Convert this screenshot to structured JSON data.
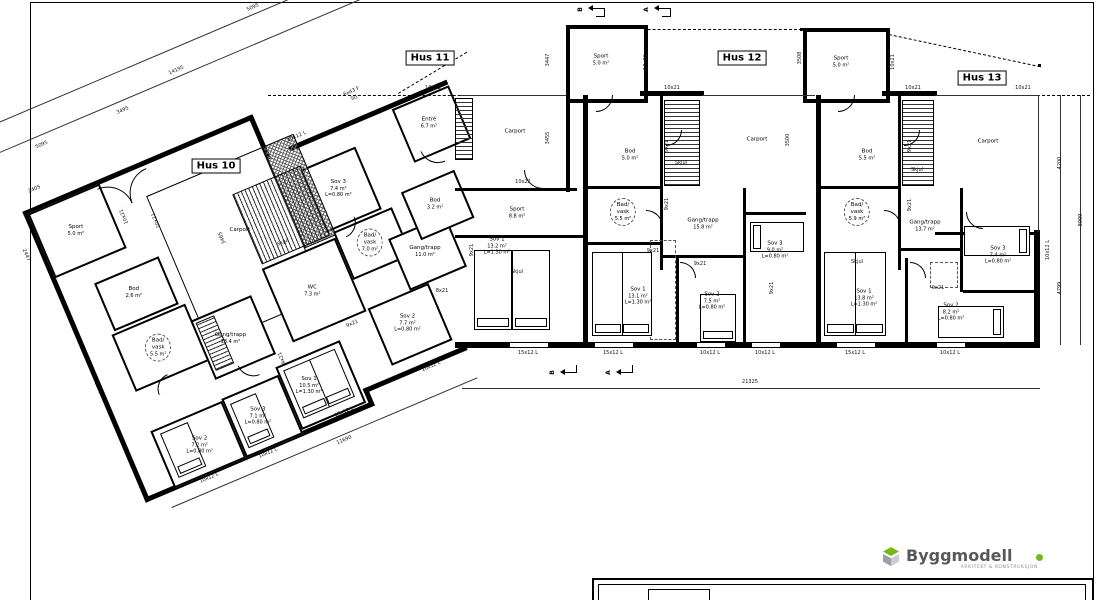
{
  "houses": {
    "h10": "Hus 10",
    "h11": "Hus 11",
    "h12": "Hus 12",
    "h13": "Hus 13"
  },
  "rooms": {
    "h10_sport": {
      "n": "Sport",
      "a": "5.0 m²"
    },
    "h10_carport": {
      "n": "Carport"
    },
    "h10_bod": {
      "n": "Bod",
      "a": "2.6 m²"
    },
    "h10_bad": {
      "n": "Bad/",
      "n2": "vask",
      "a": "5.5 m²"
    },
    "h10_gang": {
      "n": "Gang/trapp",
      "a": "13.4 m²"
    },
    "h10_wc": {
      "n": "WC",
      "a": "7.3 m²"
    },
    "h10_sov2": {
      "n": "Sov 2",
      "a": "7.2 m²",
      "l": "L=0.80 m²"
    },
    "h10_sov3": {
      "n": "Sov 3",
      "a": "7.1 m²",
      "l": "L=0.80 m²"
    },
    "h10_sov1": {
      "n": "Sov 1",
      "a": "10.5 m²",
      "l": "L=1.30 m²"
    },
    "h11_entre": {
      "n": "Entré",
      "a": "6.7 m²"
    },
    "h11_sov3": {
      "n": "Sov 3",
      "a": "7.4 m²",
      "l": "L=0.80 m²"
    },
    "h11_bad": {
      "n": "Bad/",
      "n2": "vask",
      "a": "7.0 m²"
    },
    "h11_gang": {
      "n": "Gang/trapp",
      "a": "11.0 m²"
    },
    "h11_sov2": {
      "n": "Sov 2",
      "a": "7.7 m²",
      "l": "L=0.80 m²"
    },
    "h11_bod": {
      "n": "Bod",
      "a": "3.2 m²"
    },
    "h11_carport": {
      "n": "Carport"
    },
    "h11_sport": {
      "n": "Sport",
      "a": "8.8 m²"
    },
    "h11_sov1": {
      "n": "Sov 1",
      "a": "13.2 m²",
      "l": "L=1.30 m²"
    },
    "shed1": {
      "n": "Sport",
      "a": "5.0 m²"
    },
    "shed2": {
      "n": "Sport",
      "a": "5.0 m²"
    },
    "h12_bod": {
      "n": "Bod",
      "a": "5.0 m²"
    },
    "h12_bad": {
      "n": "Bad/",
      "n2": "vask",
      "a": "5.5 m²"
    },
    "h12_gang": {
      "n": "Gang/trapp",
      "a": "15.8 m²"
    },
    "h12_carport": {
      "n": "Carport"
    },
    "h12_sov3": {
      "n": "Sov 3",
      "a": "9.0 m²",
      "l": "L=0.80 m²"
    },
    "h12_sov1": {
      "n": "Sov 1",
      "a": "13.1 m²",
      "l": "L=1.30 m²"
    },
    "h12_sov2": {
      "n": "Sov 2",
      "a": "7.5 m²",
      "l": "L=0.80 m²"
    },
    "h13_bod": {
      "n": "Bod",
      "a": "5.5 m²"
    },
    "h13_bad": {
      "n": "Bad/",
      "n2": "vask",
      "a": "5.9 m²"
    },
    "h13_gang": {
      "n": "Gang/trapp",
      "a": "13.7 m²"
    },
    "h13_carport": {
      "n": "Carport"
    },
    "h13_sov3": {
      "n": "Sov 3",
      "a": "7.4 m²",
      "l": "L=0.80 m²"
    },
    "h13_sov1": {
      "n": "Sov 1",
      "a": "13.8 m²",
      "l": "L=1.30 m²"
    },
    "h13_sov2": {
      "n": "Sov 2",
      "a": "8.2 m²",
      "l": "L=0.80 m²"
    }
  },
  "codes": {
    "d10x21": "10x21",
    "d9x21": "9x21",
    "d8x21": "8x21",
    "w15": "15x12 L",
    "w10": "10x12 L",
    "skjul": "Skjul",
    "sg1": "6x43 F",
    "sg2": "SG"
  },
  "dims": {
    "d5095": "5095",
    "d14195": "14195",
    "d3495": "3495",
    "d5095b": "5095",
    "d2405": "2405",
    "d2447": "2447",
    "d3465": "3465",
    "d8595": "8595",
    "d11690": "11690",
    "d21325": "21325",
    "d3447": "3447",
    "d3455": "3455",
    "d3508": "3508",
    "d3500": "3500",
    "d4200": "4200",
    "d4799": "4799",
    "d8999": "8999"
  },
  "sections": {
    "a": "A",
    "b": "B"
  },
  "logo": {
    "name": "Byggmodell",
    "tagline": "ARKITEKT & KONSTRUKSJON",
    "accent": "#7ab51d",
    "dark": "#58585a"
  }
}
